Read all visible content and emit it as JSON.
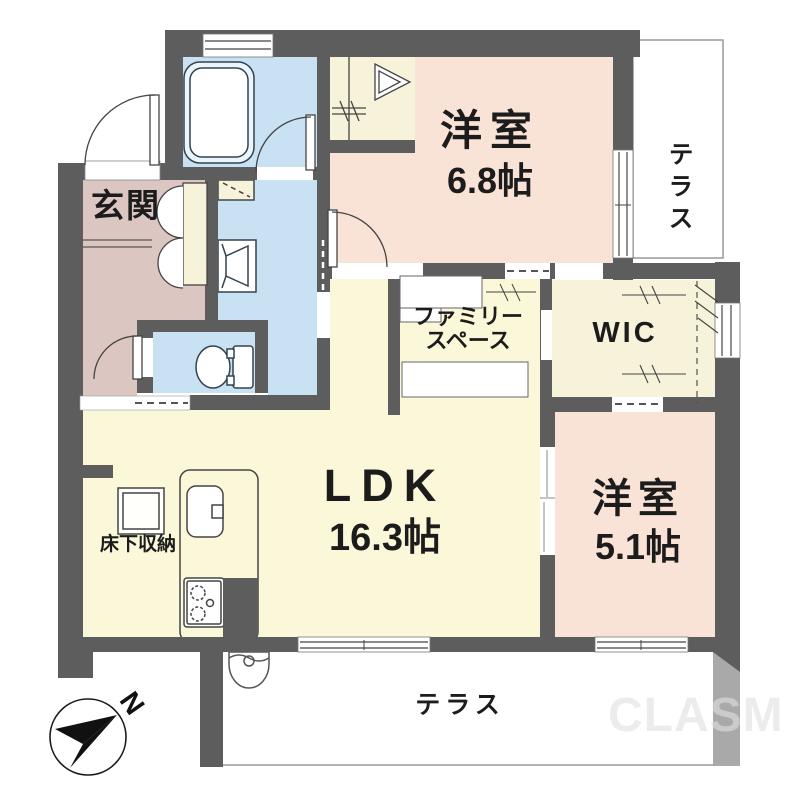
{
  "labels": {
    "genkan": "玄関",
    "room_68_name": "洋室",
    "room_68_size": "6.8帖",
    "terrace_right": "テラス",
    "family_line1": "ファミリー",
    "family_line2": "スペース",
    "wic": "WIC",
    "ldk_name": "LDK",
    "ldk_size": "16.3帖",
    "room_51_name": "洋室",
    "room_51_size": "5.1帖",
    "underfloor_storage": "床下収納",
    "terrace_bottom": "テラス",
    "compass_north": "N",
    "watermark": "CLASM"
  },
  "rooms": [
    {
      "name": "玄関",
      "type": "entrance"
    },
    {
      "name": "洋室",
      "size": "6.8帖",
      "type": "western-room"
    },
    {
      "name": "テラス",
      "type": "terrace",
      "position": "right"
    },
    {
      "name": "ファミリースペース",
      "type": "family-space"
    },
    {
      "name": "WIC",
      "type": "walk-in-closet"
    },
    {
      "name": "LDK",
      "size": "16.3帖",
      "type": "living-dining-kitchen"
    },
    {
      "name": "洋室",
      "size": "5.1帖",
      "type": "western-room"
    },
    {
      "name": "床下収納",
      "type": "underfloor-storage"
    },
    {
      "name": "テラス",
      "type": "terrace",
      "position": "bottom"
    }
  ],
  "colors": {
    "wall": "#5d5d5d",
    "wall_light": "#a9a9a9",
    "water_blue": "#c8e1f3",
    "entrance_mauve": "#dcc6c2",
    "bedroom_peach": "#f9e3d7",
    "living_yellow": "#fbf8da",
    "closet_cream": "#f7f2da",
    "terrace_border": "#999999",
    "line": "#333333"
  }
}
